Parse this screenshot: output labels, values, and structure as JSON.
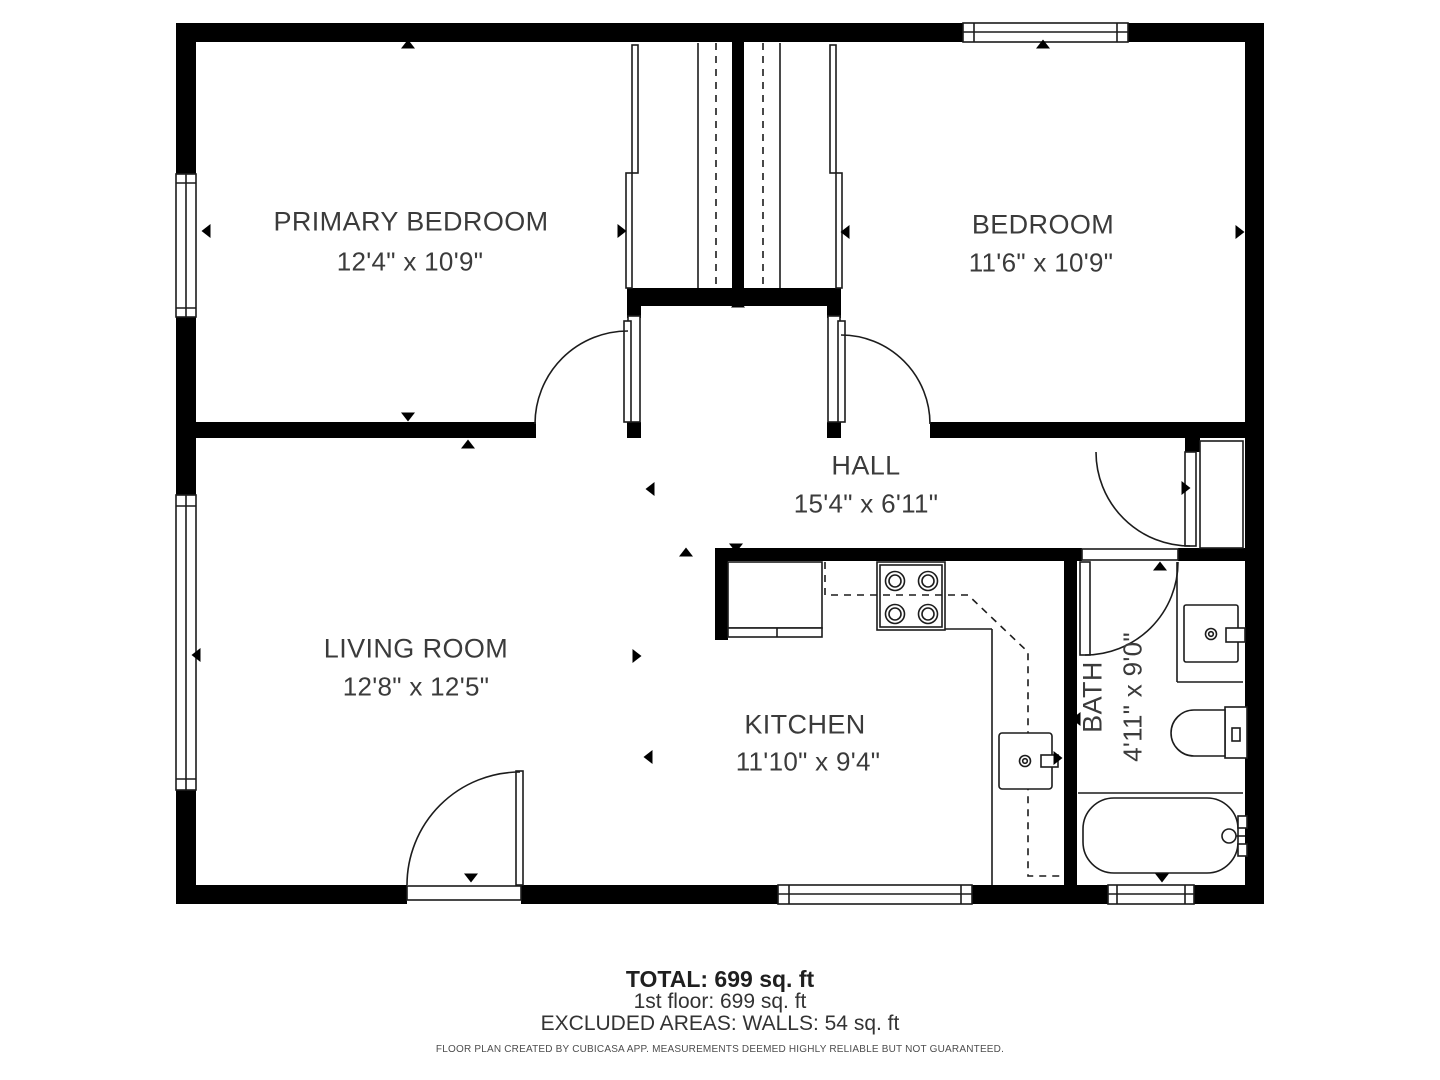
{
  "colors": {
    "wall": "#000000",
    "line": "#1c1c1c",
    "text": "#3b3b3b",
    "muted": "#4d4d4d"
  },
  "rooms": {
    "primary_bedroom": {
      "name": "PRIMARY BEDROOM",
      "dims": "12'4\" x 10'9\""
    },
    "bedroom": {
      "name": "BEDROOM",
      "dims": "11'6\" x 10'9\""
    },
    "hall": {
      "name": "HALL",
      "dims": "15'4\" x 6'11\""
    },
    "living_room": {
      "name": "LIVING ROOM",
      "dims": "12'8\" x 12'5\""
    },
    "kitchen": {
      "name": "KITCHEN",
      "dims": "11'10\" x 9'4\""
    },
    "bath": {
      "name": "BATH",
      "dims": "4'11\" x 9'0\""
    }
  },
  "summary": {
    "total": "TOTAL: 699 sq. ft",
    "floor": "1st floor: 699 sq. ft",
    "excluded": "EXCLUDED AREAS: WALLS: 54 sq. ft",
    "disclaimer": "FLOOR PLAN CREATED BY CUBICASA APP. MEASUREMENTS DEEMED HIGHLY RELIABLE BUT NOT GUARANTEED."
  },
  "fixtures": [
    "refrigerator",
    "stove",
    "kitchen-sink",
    "bathroom-vanity",
    "toilet",
    "bathtub"
  ],
  "markers": [
    {
      "x": 408,
      "y": 44,
      "dir": "up"
    },
    {
      "x": 1043,
      "y": 44,
      "dir": "up"
    },
    {
      "x": 206,
      "y": 231,
      "dir": "left"
    },
    {
      "x": 622,
      "y": 231,
      "dir": "right"
    },
    {
      "x": 845,
      "y": 232,
      "dir": "left"
    },
    {
      "x": 1240,
      "y": 232,
      "dir": "right"
    },
    {
      "x": 408,
      "y": 417,
      "dir": "down"
    },
    {
      "x": 468,
      "y": 444,
      "dir": "up"
    },
    {
      "x": 738,
      "y": 303,
      "dir": "up"
    },
    {
      "x": 650,
      "y": 489,
      "dir": "left"
    },
    {
      "x": 686,
      "y": 552,
      "dir": "up"
    },
    {
      "x": 736,
      "y": 548,
      "dir": "down"
    },
    {
      "x": 196,
      "y": 655,
      "dir": "left"
    },
    {
      "x": 637,
      "y": 656,
      "dir": "right"
    },
    {
      "x": 648,
      "y": 757,
      "dir": "left"
    },
    {
      "x": 471,
      "y": 878,
      "dir": "down"
    },
    {
      "x": 1162,
      "y": 878,
      "dir": "down"
    },
    {
      "x": 1160,
      "y": 566,
      "dir": "up"
    },
    {
      "x": 1186,
      "y": 488,
      "dir": "right"
    },
    {
      "x": 1076,
      "y": 719,
      "dir": "left"
    },
    {
      "x": 1058,
      "y": 758,
      "dir": "right"
    }
  ]
}
